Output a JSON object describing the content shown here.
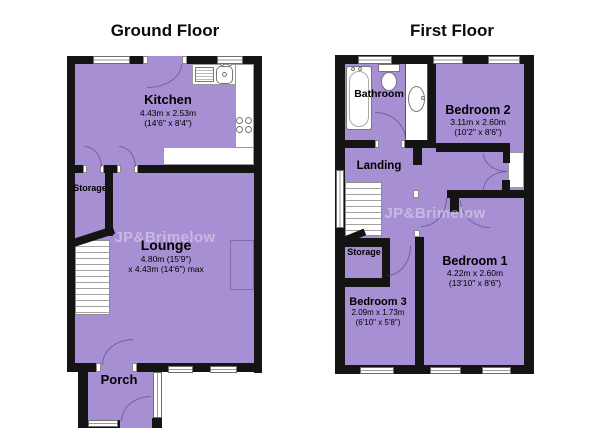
{
  "colors": {
    "room_fill": "#a78fd4",
    "wall": "#141414"
  },
  "ground_floor": {
    "title": "Ground Floor",
    "watermark": "JP&Brimelow",
    "rooms": {
      "kitchen": {
        "name": "Kitchen",
        "dim_metric": "4.43m x 2.53m",
        "dim_imperial": "(14'6\" x 8'4\")"
      },
      "storage": {
        "name": "Storage"
      },
      "lounge": {
        "name": "Lounge",
        "dim_line1": "4.80m (15'9\")",
        "dim_line2": "x 4.43m (14'6\") max"
      },
      "porch": {
        "name": "Porch"
      }
    }
  },
  "first_floor": {
    "title": "First Floor",
    "watermark": "JP&Brimelow",
    "rooms": {
      "bathroom": {
        "name": "Bathroom"
      },
      "landing": {
        "name": "Landing"
      },
      "storage": {
        "name": "Storage"
      },
      "bedroom2": {
        "name": "Bedroom 2",
        "dim_metric": "3.11m x 2.60m",
        "dim_imperial": "(10'2\" x 8'6\")"
      },
      "bedroom1": {
        "name": "Bedroom 1",
        "dim_metric": "4.22m x 2.60m",
        "dim_imperial": "(13'10\" x 8'6\")"
      },
      "bedroom3": {
        "name": "Bedroom 3",
        "dim_metric": "2.09m x 1.73m",
        "dim_imperial": "(6'10\" x 5'8\")"
      }
    }
  }
}
